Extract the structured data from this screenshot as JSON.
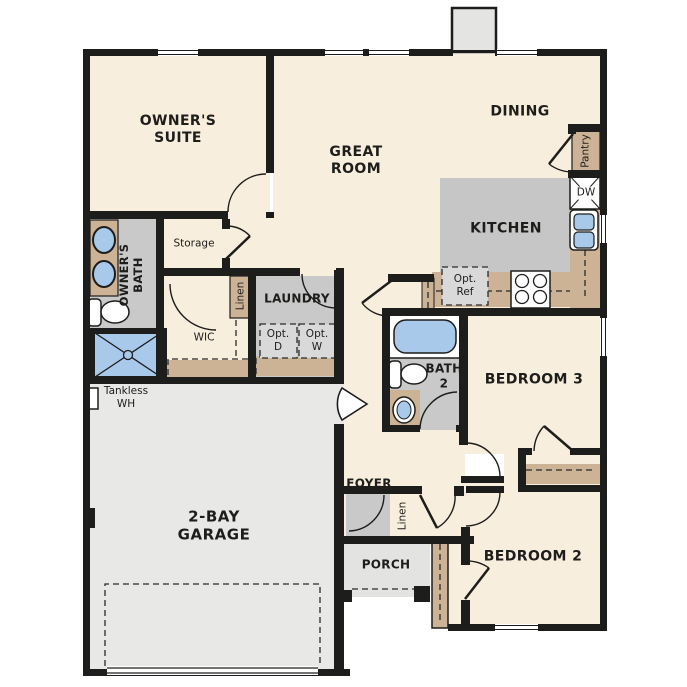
{
  "plan_title": "3-bedroom single-story floor plan",
  "colors": {
    "wall": "#1d1d1b",
    "floor_cream": "#f8eedd",
    "room_grey": "#c9c9c9",
    "kitchen_grey": "#c6c6c6",
    "counter_tan": "#ccb396",
    "fixture_blue": "#a9c9ea",
    "garage_grey": "#e8e8e6",
    "porch_grey": "#e3e3e1",
    "opt_grey": "#d9d9d9"
  },
  "labels": {
    "owners_suite": "OWNER'S\nSUITE",
    "great_room": "GREAT\nROOM",
    "dining": "DINING",
    "kitchen": "KITCHEN",
    "owners_bath": "OWNER'S\nBATH",
    "storage": "Storage",
    "wic": "WIC",
    "linen_hall": "Linen",
    "laundry": "LAUNDRY",
    "opt_d": "Opt.\nD",
    "opt_w": "Opt.\nW",
    "opt_ref": "Opt.\nRef",
    "pantry": "Pantry",
    "dw": "DW",
    "bath2": "BATH\n2",
    "bedroom3": "BEDROOM 3",
    "bedroom2": "BEDROOM 2",
    "foyer": "FOYER",
    "linen_foyer": "Linen",
    "porch": "PORCH",
    "garage": "2-BAY\nGARAGE",
    "tankless_wh": "Tankless\nWH"
  }
}
